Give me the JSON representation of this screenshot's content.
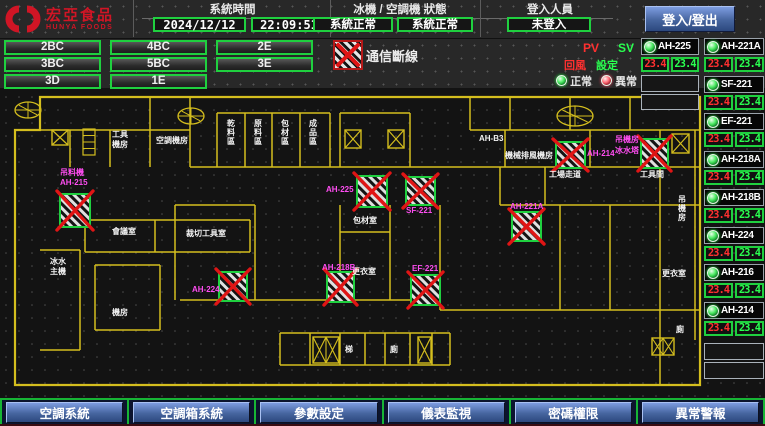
{
  "header": {
    "brand": {
      "name": "宏亞食品",
      "name_en": "HUNYA FOODS"
    },
    "time_section": {
      "title": "系統時間",
      "date": "2024/12/12",
      "time": "22:09:51"
    },
    "status_section": {
      "title": "冰機 / 空調機 狀態",
      "chiller": "系統正常",
      "ahu": "系統正常"
    },
    "login_section": {
      "title": "登入人員",
      "user": "未登入",
      "logout_button": "登入/登出"
    }
  },
  "floor_buttons": [
    "2BC",
    "4BC",
    "2E",
    "3BC",
    "5BC",
    "3E",
    "3D",
    "1E"
  ],
  "legend": {
    "comm_fail": "通信斷線",
    "pv": "PV",
    "sv": "SV",
    "pv_row": "回風",
    "sv_row": "設定",
    "normal": "正常",
    "abnormal": "異常"
  },
  "equipment": {
    "left_column": [
      {
        "name": "AH-225",
        "pv": "23.4",
        "sv": "23.4"
      }
    ],
    "right_column": [
      {
        "name": "AH-221A",
        "pv": "23.4",
        "sv": "23.4"
      },
      {
        "name": "SF-221",
        "pv": "23.4",
        "sv": "23.4"
      },
      {
        "name": "EF-221",
        "pv": "23.4",
        "sv": "23.4"
      },
      {
        "name": "AH-218A",
        "pv": "23.4",
        "sv": "23.4"
      },
      {
        "name": "AH-218B",
        "pv": "23.4",
        "sv": "23.4"
      },
      {
        "name": "AH-224",
        "pv": "23.4",
        "sv": "23.4"
      },
      {
        "name": "AH-216",
        "pv": "23.4",
        "sv": "23.4"
      },
      {
        "name": "AH-214",
        "pv": "23.4",
        "sv": "23.4"
      }
    ]
  },
  "floorplan": {
    "room_labels": [
      {
        "text": "工具",
        "x": 112,
        "y": 137
      },
      {
        "text": "機房",
        "x": 112,
        "y": 147
      },
      {
        "text": "空調機房",
        "x": 156,
        "y": 143
      },
      {
        "text": "AH-B3",
        "x": 479,
        "y": 141
      },
      {
        "text": "機械排風機房",
        "x": 505,
        "y": 158
      },
      {
        "text": "工場走道",
        "x": 549,
        "y": 177
      },
      {
        "text": "工具間",
        "x": 640,
        "y": 177
      },
      {
        "text": "會議室",
        "x": 112,
        "y": 234
      },
      {
        "text": "裁切工具室",
        "x": 186,
        "y": 236
      },
      {
        "text": "包材室",
        "x": 353,
        "y": 223
      },
      {
        "text": "更衣室",
        "x": 352,
        "y": 274
      },
      {
        "text": "冰水",
        "x": 50,
        "y": 264
      },
      {
        "text": "主機",
        "x": 50,
        "y": 274
      },
      {
        "text": "機房",
        "x": 112,
        "y": 315
      },
      {
        "text": "梯",
        "x": 345,
        "y": 352
      },
      {
        "text": "廁",
        "x": 390,
        "y": 352
      },
      {
        "text": "更衣室",
        "x": 662,
        "y": 276
      },
      {
        "text": "廁",
        "x": 676,
        "y": 332
      },
      {
        "text": "乾料區",
        "x": 227,
        "y": 118,
        "vertical": true
      },
      {
        "text": "原料區",
        "x": 254,
        "y": 118,
        "vertical": true
      },
      {
        "text": "包材區",
        "x": 281,
        "y": 118,
        "vertical": true
      },
      {
        "text": "成品區",
        "x": 309,
        "y": 118,
        "vertical": true
      },
      {
        "text": "吊機房",
        "x": 678,
        "y": 194,
        "vertical": true
      }
    ],
    "device_labels": [
      {
        "text": "吊料機",
        "x": 60,
        "y": 175
      },
      {
        "text": "AH-215",
        "x": 60,
        "y": 185
      },
      {
        "text": "AH-225",
        "x": 326,
        "y": 192
      },
      {
        "text": "SF-221",
        "x": 406,
        "y": 213
      },
      {
        "text": "AH-218B",
        "x": 322,
        "y": 270
      },
      {
        "text": "EF-221",
        "x": 412,
        "y": 271
      },
      {
        "text": "AH-224",
        "x": 192,
        "y": 292
      },
      {
        "text": "AH-221A",
        "x": 510,
        "y": 209
      },
      {
        "text": "AH-214",
        "x": 587,
        "y": 156
      },
      {
        "text": "吊機房",
        "x": 615,
        "y": 142
      },
      {
        "text": "冰水塔",
        "x": 615,
        "y": 153
      }
    ],
    "fail_boxes": [
      [
        60,
        194,
        30,
        33
      ],
      [
        357,
        176,
        30,
        31
      ],
      [
        406,
        177,
        29,
        28
      ],
      [
        327,
        272,
        27,
        30
      ],
      [
        411,
        275,
        29,
        30
      ],
      [
        219,
        272,
        28,
        29
      ],
      [
        512,
        212,
        29,
        29
      ],
      [
        556,
        142,
        29,
        26
      ],
      [
        641,
        139,
        27,
        29
      ]
    ],
    "stair_boxes": [
      [
        52,
        130,
        16,
        15
      ],
      [
        345,
        130,
        16,
        18
      ],
      [
        388,
        130,
        16,
        18
      ],
      [
        672,
        134,
        17,
        19
      ],
      [
        418,
        337,
        13,
        26
      ]
    ],
    "double_stair_boxes": [
      [
        313,
        337,
        26,
        26
      ],
      [
        652,
        338,
        22,
        17
      ]
    ],
    "spirals": [
      [
        28,
        110,
        13,
        8
      ],
      [
        191,
        116,
        13,
        8
      ],
      [
        575,
        116,
        18,
        10
      ]
    ],
    "ladders": [
      [
        83,
        129,
        12,
        26
      ]
    ]
  },
  "bottom_nav": [
    "空調系統",
    "空調箱系統",
    "參數設定",
    "儀表監視",
    "密碼權限",
    "異常警報"
  ],
  "colors": {
    "accent_green": "#1fd03f",
    "alarm_red": "#e01515",
    "device_magenta": "#ff4df2",
    "wall_yellow": "#d4be1e",
    "button_blue": "#46659f"
  }
}
